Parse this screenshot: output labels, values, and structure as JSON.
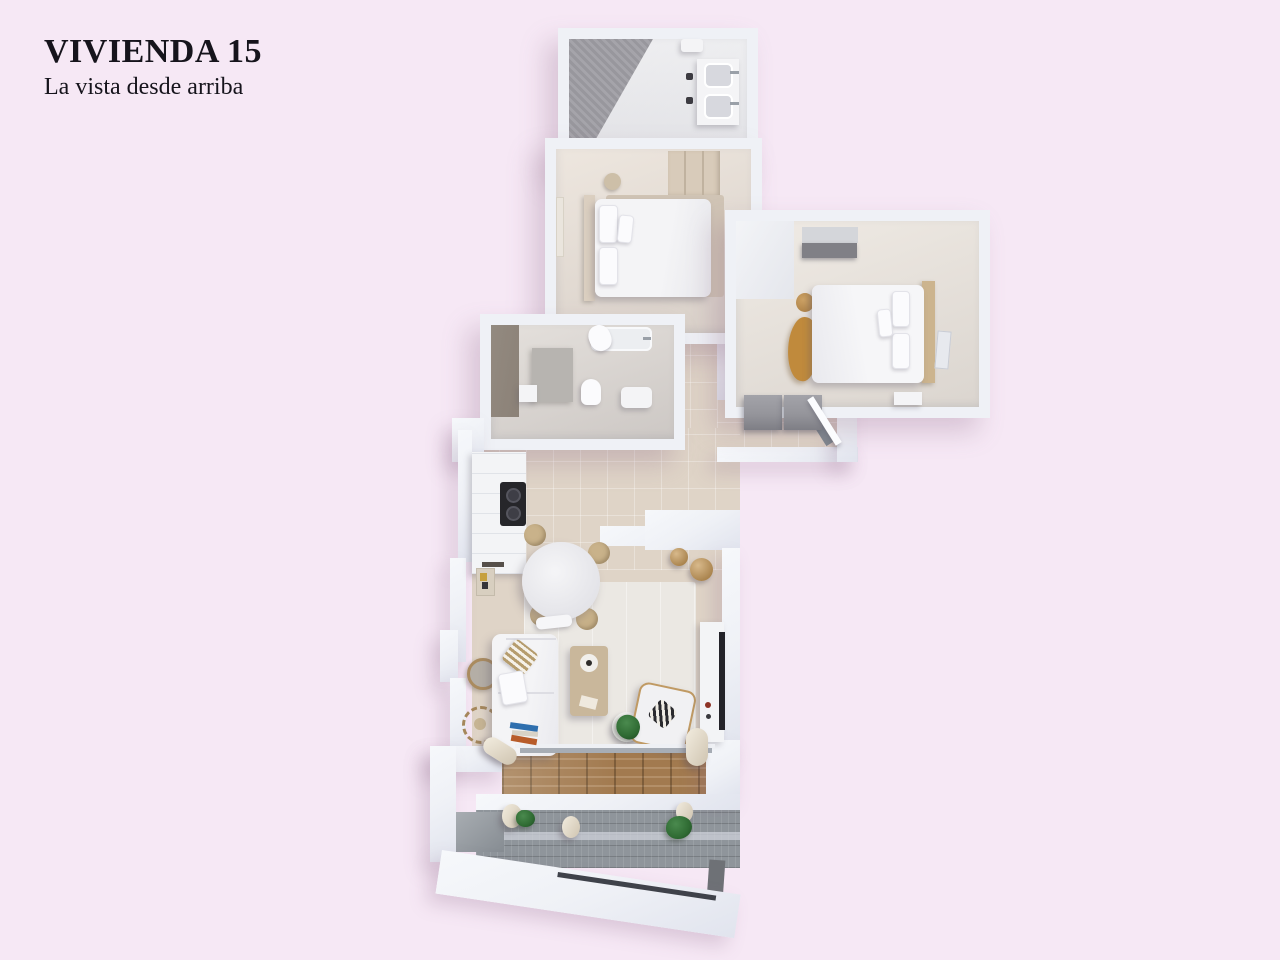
{
  "page": {
    "background": "#f6e8f5",
    "width": 1280,
    "height": 960
  },
  "header": {
    "title": "VIVIENDA 15",
    "subtitle": "La vista desde arriba",
    "text_color": "#16141c"
  },
  "palette": {
    "bg": "#f6e8f5",
    "ink": "#16141c",
    "wall": "#eff1f6",
    "wall_edge": "#dcdfe9",
    "floor_beige": "#dfd4c7",
    "floor_light": "#ebe8e3",
    "floor_bath": "#dad4ce",
    "shower_tile": "#96959b",
    "taupe_panel": "#8b8177",
    "deck_wood": "#a27a4f",
    "headboard_wood": "#ccb48e",
    "gold_throw": "#c08a3c",
    "plant": "#2f6b33",
    "appliance_dark": "#26262a",
    "cab": "#95959b",
    "white_furn": "#f4f4f6",
    "balcony_gray": "#8f959b"
  },
  "floorplan": {
    "view": "top-down 3D render of apartment unit 15",
    "rooms": [
      {
        "id": "bathroom-top",
        "furniture": [
          "walk-in-shower",
          "double-sink-vanity",
          "toilet",
          "waste-bin"
        ]
      },
      {
        "id": "bedroom-1",
        "furniture": [
          "double-bed",
          "pillows",
          "headboard",
          "area-rug",
          "wardrobe",
          "nightstand",
          "wall-art"
        ]
      },
      {
        "id": "bedroom-2",
        "furniture": [
          "double-bed",
          "wood-headboard",
          "built-in-closet",
          "gold-throw",
          "basket",
          "nightstand",
          "leaning-mirror"
        ]
      },
      {
        "id": "bathroom-2",
        "furniture": [
          "bathtub",
          "towel",
          "toilet",
          "washbasin",
          "low-cabinet",
          "partition"
        ]
      },
      {
        "id": "entry-hall",
        "furniture": [
          "storage-cabinets",
          "entrance-door"
        ]
      },
      {
        "id": "kitchen",
        "furniture": [
          "counter",
          "cooktop"
        ]
      },
      {
        "id": "living-dining",
        "furniture": [
          "round-dining-table",
          "rattan-chairs",
          "bench",
          "sofa",
          "striped-pillow",
          "books",
          "coffee-table",
          "potted-plant",
          "armchair",
          "tv-console",
          "poufs",
          "round-mirror",
          "sunburst-mirror",
          "area-rug",
          "wall-art"
        ]
      },
      {
        "id": "terrace",
        "furniture": [
          "wood-deck",
          "planters",
          "plants",
          "lower-balcony",
          "parapet"
        ]
      }
    ]
  }
}
